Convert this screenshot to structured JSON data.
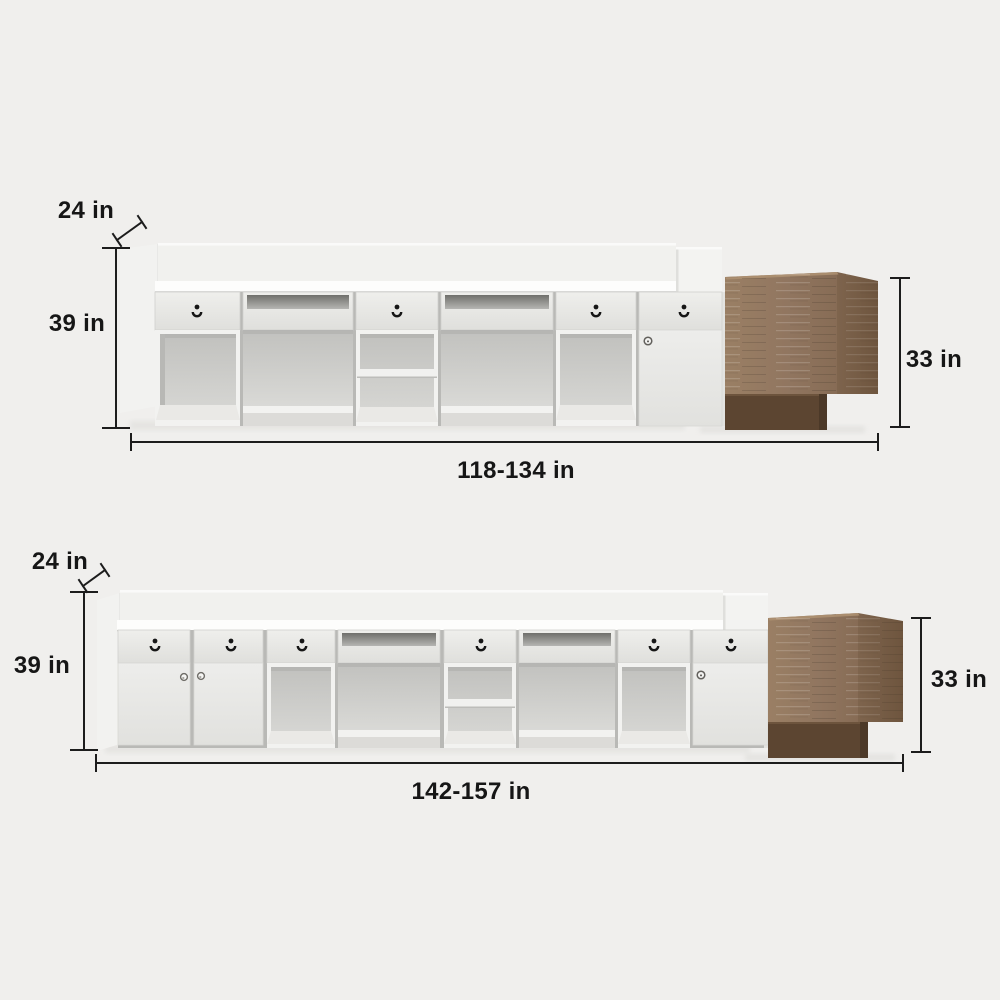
{
  "page": {
    "background_color": "#f0efed",
    "unit": "in"
  },
  "colors": {
    "dimension_line": "#1c1c1c",
    "label_text": "#161616",
    "desk_white": "#f2f2f0",
    "counter_highlight": "#fdfdfc",
    "interior_gray": "#cfcfcc",
    "wood_front": "#95795e",
    "wood_side": "#775d46",
    "wood_plinth": "#5c4531"
  },
  "icons": {
    "drawer_lock": "keyhole-icon",
    "door_knob": "knob-icon",
    "cabinet_lock": "lock-icon"
  },
  "figures": [
    {
      "id": "desk-variant-1",
      "labels": {
        "depth": "24 in",
        "height": "39 in",
        "return_height": "33 in",
        "width_range": "118-134 in"
      }
    },
    {
      "id": "desk-variant-2",
      "labels": {
        "depth": "24 in",
        "height": "39 in",
        "return_height": "33 in",
        "width_range": "142-157 in"
      }
    }
  ]
}
